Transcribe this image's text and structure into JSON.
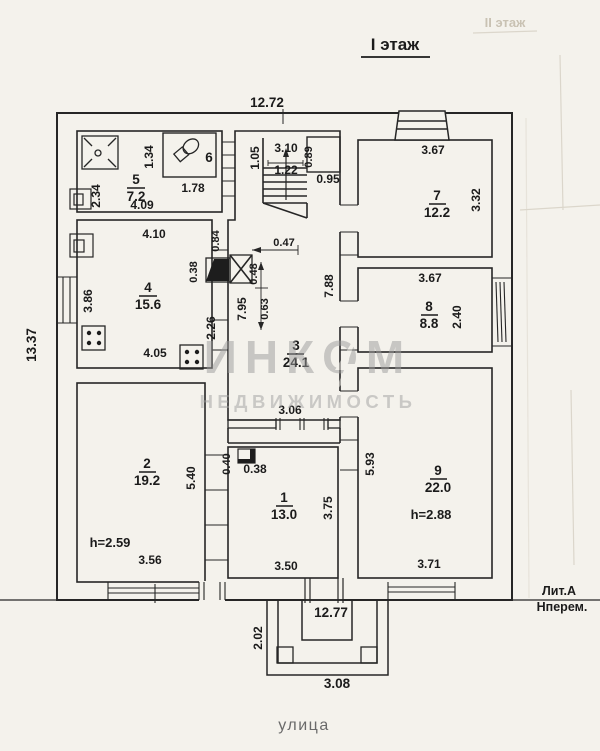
{
  "page": {
    "title": "I этаж",
    "bleed_title": "II этаж",
    "street_label": "улица",
    "building_letter": "Лит.А",
    "building_note": "Нперем."
  },
  "watermark": {
    "brand": "ИНКОМ",
    "subtitle": "НЕДВИЖИМОСТЬ"
  },
  "overall_dims": {
    "top_width_m": "12.72",
    "left_height_m": "13.37",
    "bottom_width_m": "12.77",
    "porch_depth_m": "2.02",
    "porch_width_m": "3.08"
  },
  "rooms": {
    "r1": {
      "num": "1",
      "area": "13.0",
      "dim_bottom": "3.50",
      "dim_right": "3.75",
      "flue_h": "0.40",
      "flue_w": "0.38"
    },
    "r2": {
      "num": "2",
      "area": "19.2",
      "dim_bottom": "3.56",
      "dim_right": "5.40",
      "ceiling": "h=2.59"
    },
    "r3": {
      "num": "3",
      "area": "24.1",
      "dim_left": "2.26",
      "dim_left_wall": "7.95",
      "dim_right_wall": "7.88",
      "dim_bottom": "3.06"
    },
    "r4": {
      "num": "4",
      "area": "15.6",
      "dim_left": "3.86",
      "dim_top": "4.10",
      "dim_bottom": "4.05"
    },
    "r5": {
      "num": "5",
      "area": "7.2",
      "dim_left": "2.34",
      "dim_bottom": "4.09"
    },
    "r6": {
      "num": "6",
      "dim_left": "1.34",
      "dim_bottom": "1.78"
    },
    "r7": {
      "num": "7",
      "area": "12.2",
      "dim_top": "3.67",
      "dim_right": "3.32"
    },
    "r8": {
      "num": "8",
      "area": "8.8",
      "dim_top": "3.67",
      "dim_right": "2.40"
    },
    "r9": {
      "num": "9",
      "area": "22.0",
      "dim_left": "5.93",
      "dim_bottom": "3.71",
      "ceiling": "h=2.88"
    }
  },
  "stairs": {
    "hall_width": "1.05",
    "top_width": "3.10",
    "run": "1.22",
    "side": "0.89",
    "closet": "0.95"
  },
  "furnace": {
    "d_wall": "0.84",
    "d_depth": "0.47",
    "d_front": "0.38",
    "d_side": "0.48",
    "d_back": "0.63"
  }
}
